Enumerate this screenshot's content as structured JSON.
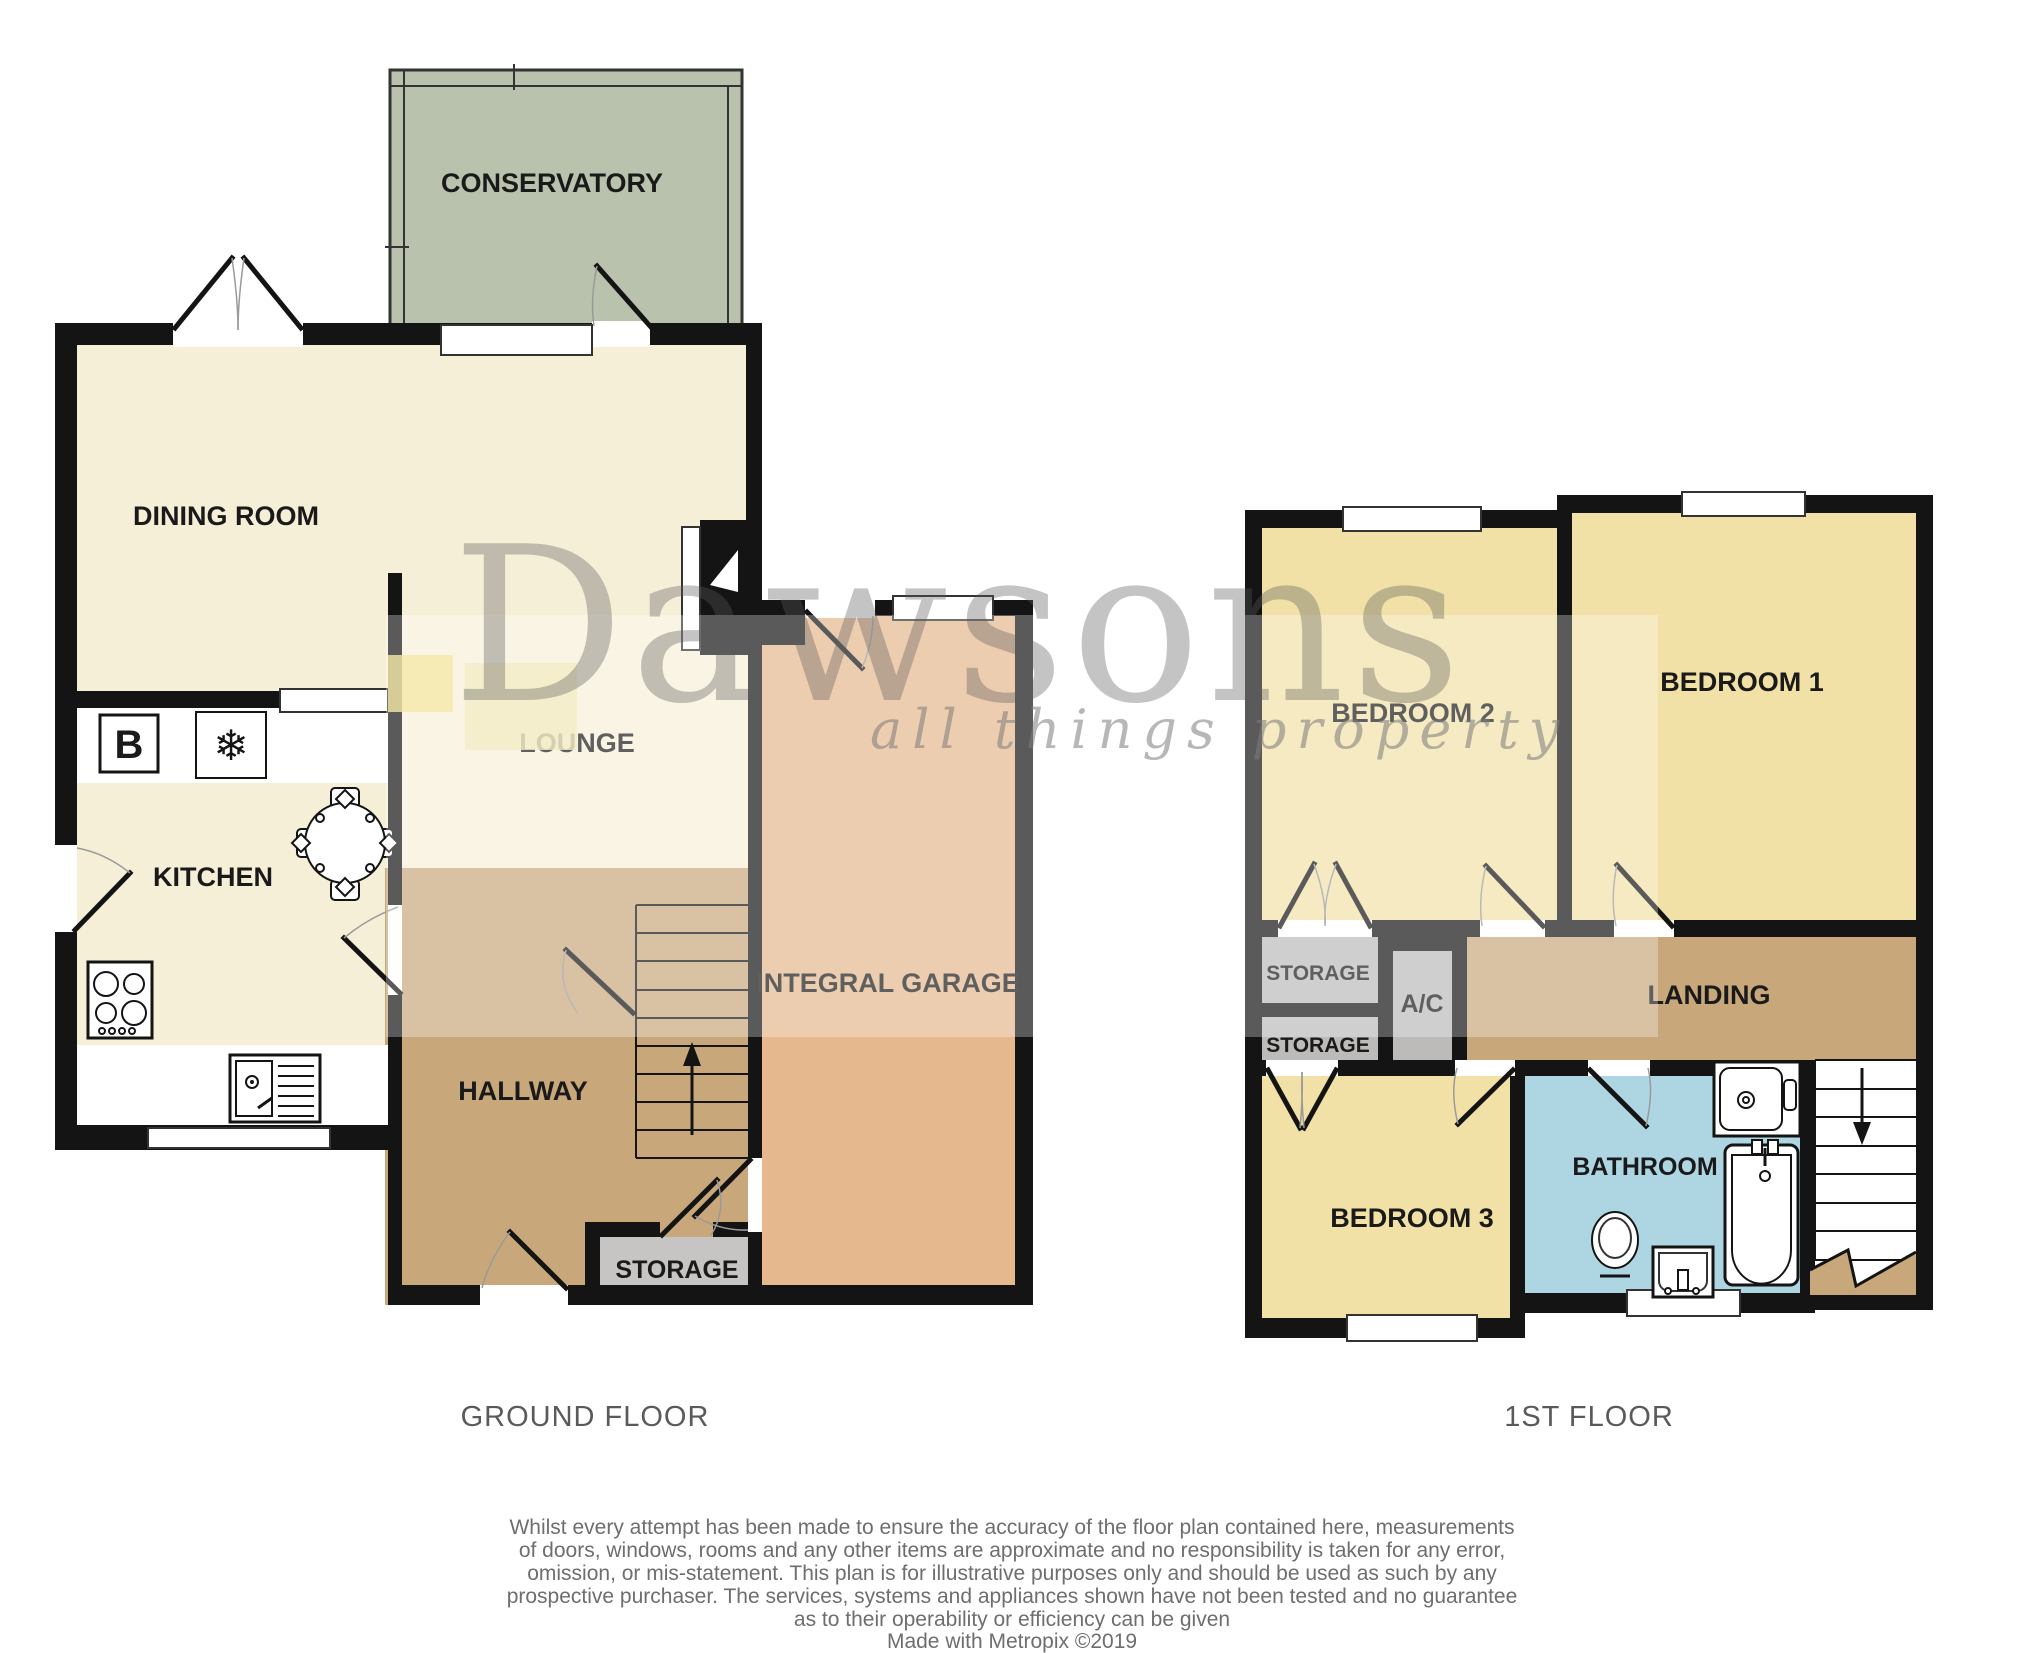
{
  "ground_floor": {
    "caption": "GROUND FLOOR",
    "rooms": {
      "conservatory": "CONSERVATORY",
      "dining": "DINING ROOM",
      "kitchen": "KITCHEN",
      "lounge": "LOUNGE",
      "hallway": "HALLWAY",
      "storage": "STORAGE",
      "garage": "INTEGRAL GARAGE"
    },
    "appliances": {
      "boiler": "B",
      "freezer": "❄"
    }
  },
  "first_floor": {
    "caption": "1ST FLOOR",
    "rooms": {
      "bedroom2": "BEDROOM 2",
      "bedroom1": "BEDROOM 1",
      "storage_top": "STORAGE",
      "storage_bottom": "STORAGE",
      "ac": "A/C",
      "landing": "LANDING",
      "bedroom3": "BEDROOM 3",
      "bathroom": "BATHROOM"
    }
  },
  "watermark": {
    "brand": "Dawsons",
    "tagline": "all things property"
  },
  "footer": {
    "disclaimer_lines": [
      "Whilst every attempt has been made to ensure the accuracy of the floor plan contained here, measurements",
      "of doors, windows, rooms and any other items are approximate and no responsibility is taken for any error,",
      "omission, or mis-statement. This plan is for illustrative purposes only and should be used as such by any",
      "prospective purchaser. The services, systems and appliances shown have not been tested and no guarantee",
      "as to their operability or efficiency can be given"
    ],
    "credit": "Made with Metropix ©2019"
  },
  "colors": {
    "wall": "#141414",
    "cream": "#f6efd7",
    "tan": "#c8a87b",
    "garage_tan": "#e6b88d",
    "conservatory_green": "#b8c2ac",
    "bedroom_yellow": "#f1e1a6",
    "bathroom_blue": "#add6e2",
    "storage_grey": "#bcbbba",
    "storage_grey_ground": "#c6c5c4",
    "gold_big": "#f3ecc6",
    "gold_small": "#f5e8a8"
  }
}
